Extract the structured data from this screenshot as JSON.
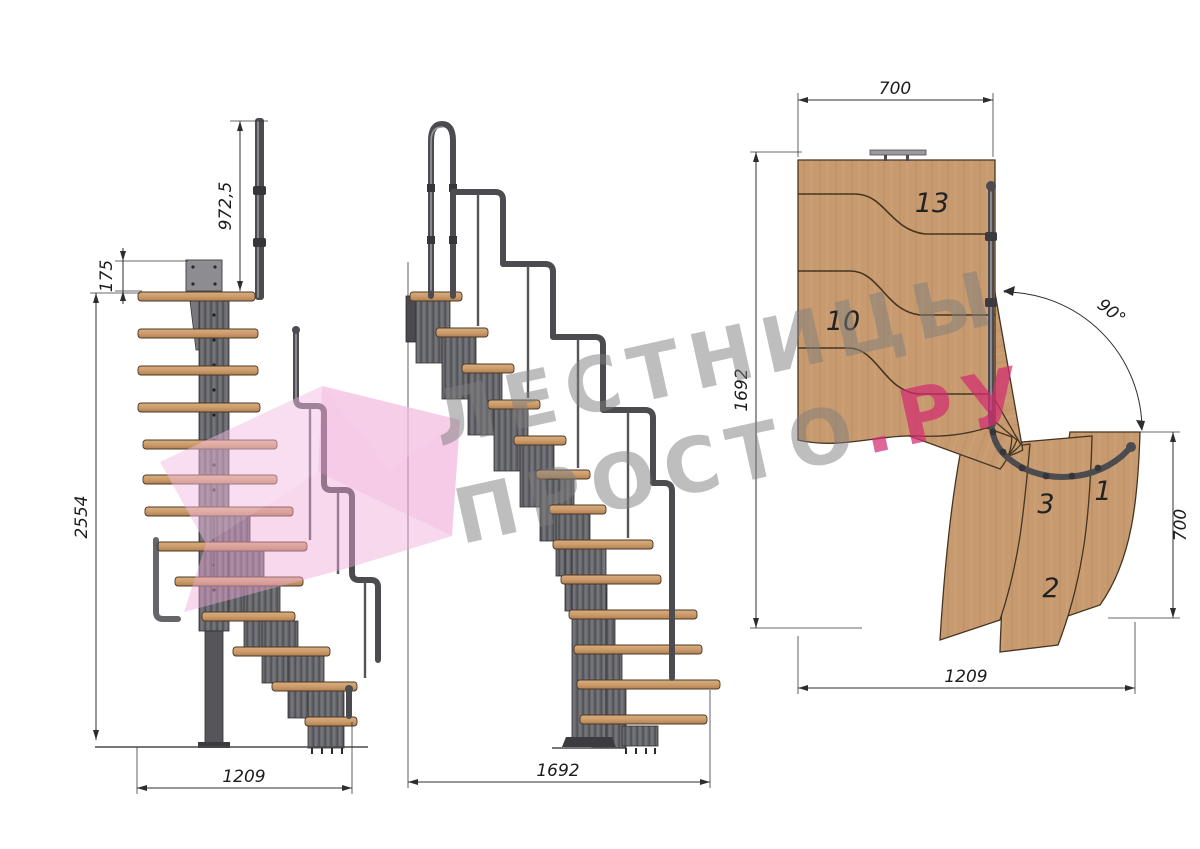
{
  "watermark": {
    "line1": "ЛЕСТНИЦЫ",
    "line2": "ПРОСТО",
    "line2_suffix": ".РУ"
  },
  "left_view": {
    "rail_height": "972,5",
    "top_offset": "175",
    "total_height": "2554",
    "width": "1209"
  },
  "middle_view": {
    "length": "1692"
  },
  "plan_view": {
    "top_width": "700",
    "left_length": "1692",
    "right_width": "700",
    "bottom_length": "1209",
    "angle": "90°",
    "steps": {
      "n13": "13",
      "n10": "10",
      "n3": "3",
      "n1": "1",
      "n2": "2"
    }
  },
  "colors": {
    "wood": "#c79b6f",
    "metal": "#55555a",
    "accent_pink": "#d63c78",
    "watermark_gray": "#8f8f8f",
    "logo_pink": "#f2aedd"
  }
}
